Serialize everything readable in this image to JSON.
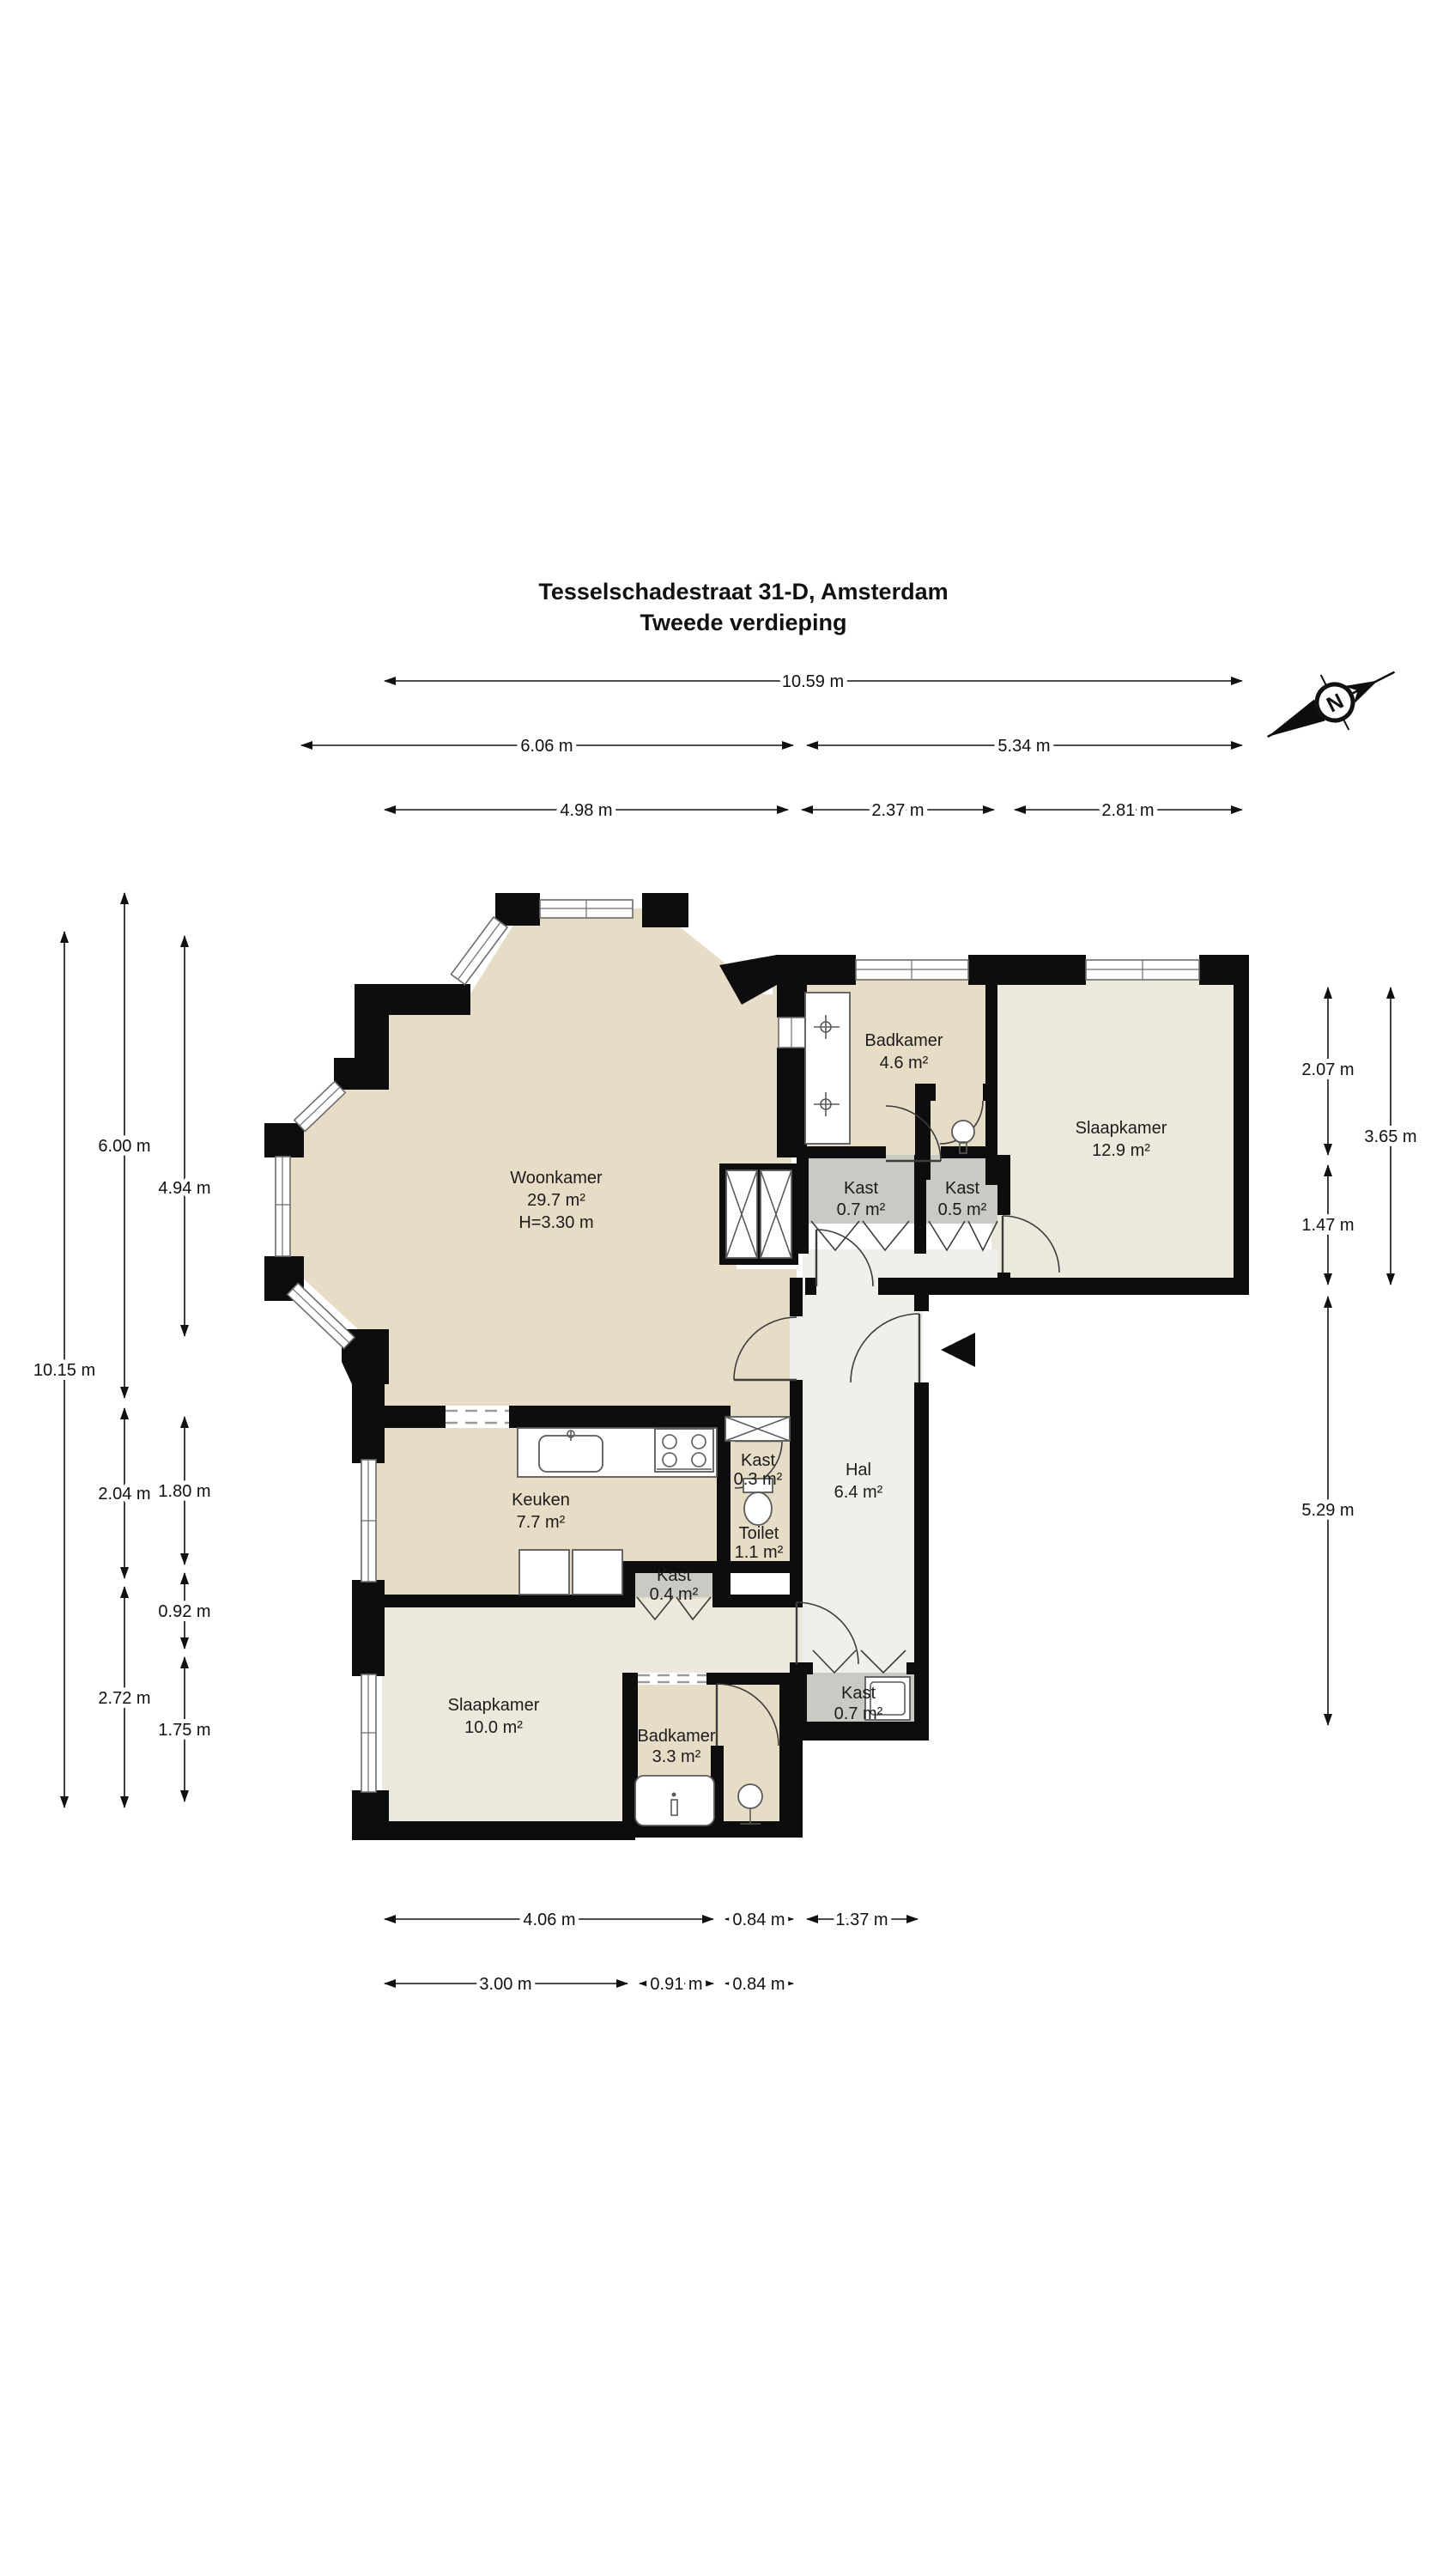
{
  "title": {
    "line1": "Tesselschadestraat 31-D, Amsterdam",
    "line2": "Tweede verdieping"
  },
  "compass": {
    "label": "N"
  },
  "colors": {
    "wall": "#0d0d0d",
    "room_tan": "#e7dcc6",
    "room_light": "#ece8db",
    "hall": "#f0efe9",
    "closet_gray": "#c8cac3",
    "background": "#ffffff"
  },
  "rooms": {
    "woonkamer": {
      "name": "Woonkamer",
      "area": "29.7 m²",
      "height": "H=3.30 m"
    },
    "badkamer_boven": {
      "name": "Badkamer",
      "area": "4.6 m²"
    },
    "slaapkamer_rechts": {
      "name": "Slaapkamer",
      "area": "12.9 m²"
    },
    "kast_07_boven": {
      "name": "Kast",
      "area": "0.7 m²"
    },
    "kast_05": {
      "name": "Kast",
      "area": "0.5 m²"
    },
    "keuken": {
      "name": "Keuken",
      "area": "7.7 m²"
    },
    "kast_03": {
      "name": "Kast",
      "area": "0.3 m²"
    },
    "toilet": {
      "name": "Toilet",
      "area": "1.1 m²"
    },
    "hal": {
      "name": "Hal",
      "area": "6.4 m²"
    },
    "kast_04": {
      "name": "Kast",
      "area": "0.4 m²"
    },
    "slaapkamer_links": {
      "name": "Slaapkamer",
      "area": "10.0 m²"
    },
    "badkamer_beneden": {
      "name": "Badkamer",
      "area": "3.3 m²"
    },
    "kast_07_beneden": {
      "name": "Kast",
      "area": "0.7 m²"
    }
  },
  "dimensions": {
    "top": [
      {
        "label": "10.59 m"
      },
      {
        "label": "6.06 m"
      },
      {
        "label": "5.34 m"
      },
      {
        "label": "4.98 m"
      },
      {
        "label": "2.37 m"
      },
      {
        "label": "2.81 m"
      }
    ],
    "left": [
      {
        "label": "10.15 m"
      },
      {
        "label": "6.00 m"
      },
      {
        "label": "2.04 m"
      },
      {
        "label": "2.72 m"
      },
      {
        "label": "4.94 m"
      },
      {
        "label": "1.80 m"
      },
      {
        "label": "0.92 m"
      },
      {
        "label": "1.75 m"
      }
    ],
    "right": [
      {
        "label": "2.07 m"
      },
      {
        "label": "1.47 m"
      },
      {
        "label": "5.29 m"
      },
      {
        "label": "3.65 m"
      }
    ],
    "bottom": [
      {
        "label": "4.06 m"
      },
      {
        "label": "0.84 m"
      },
      {
        "label": "1.37 m"
      },
      {
        "label": "3.00 m"
      },
      {
        "label": "0.91 m"
      },
      {
        "label": "0.84 m"
      }
    ]
  }
}
